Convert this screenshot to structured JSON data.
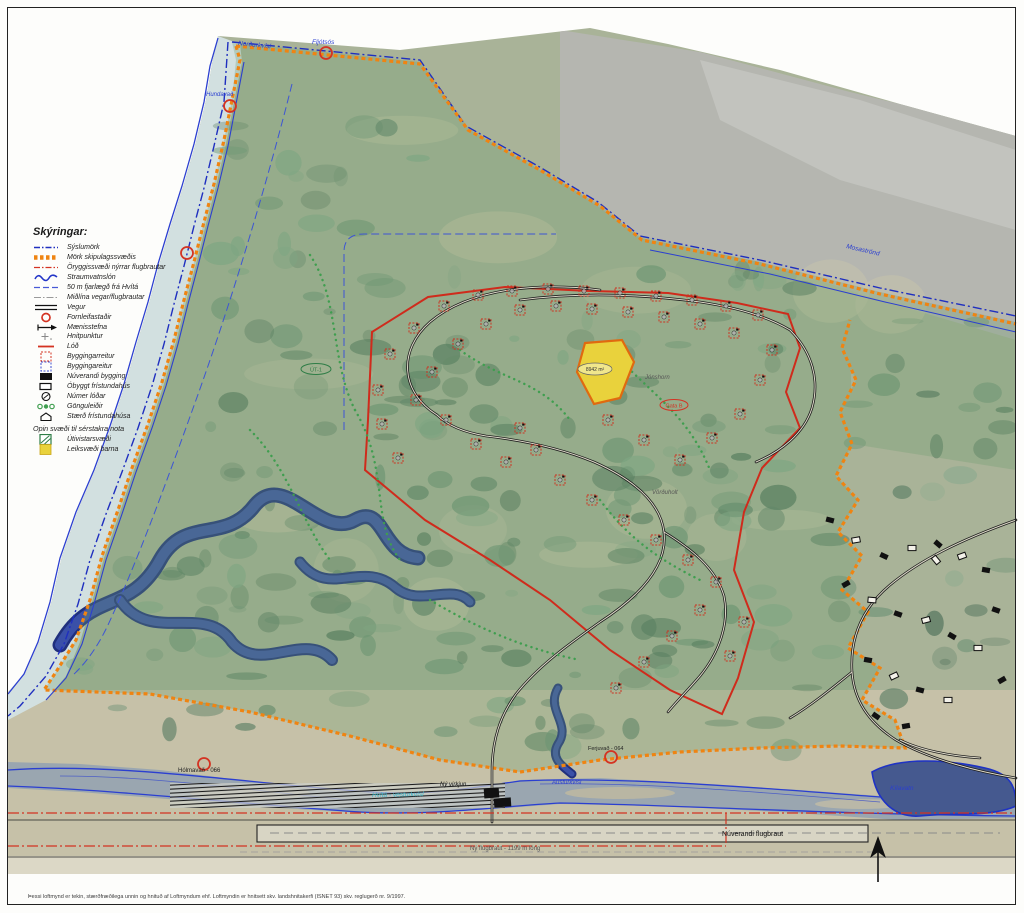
{
  "legend": {
    "title": "Skýringar:",
    "items": [
      {
        "label": "Sýslumörk"
      },
      {
        "label": "Mörk skipulagssvæðis"
      },
      {
        "label": "Öryggissvæði nýrrar flugbrautar"
      },
      {
        "label": "Straumvatnslón"
      },
      {
        "label": "50 m fjarlægð frá Hvítá"
      },
      {
        "label": "Miðlína vegar/flugbrautar"
      },
      {
        "label": "Vegur"
      },
      {
        "label": "Fornleifastaðir"
      },
      {
        "label": "Mænisstefna"
      },
      {
        "label": "Hnitpunktur"
      },
      {
        "label": "Lóð"
      },
      {
        "label": "Byggingarreitur"
      },
      {
        "label": "Byggingareitur"
      },
      {
        "label": "Núverandi bygging"
      },
      {
        "label": "Óbyggt frístundahús"
      },
      {
        "label": "Númer lóðar"
      },
      {
        "label": "Gönguleiðir"
      },
      {
        "label": "Stærð frístundahúsa"
      }
    ],
    "subheader": "Opin svæði til sérstakra nota",
    "open_items": [
      {
        "label": "Útivistarsvæði"
      },
      {
        "label": "Leiksvæði barna"
      }
    ]
  },
  "map_labels": {
    "river_top_left": "Norðurkvísl",
    "river_top_mid": "Fljótsós",
    "river_left": "Hundavað",
    "county_line_ne": "Mosaströnd",
    "open_area_tag": "ÚT-1",
    "playground_size": "8942 m²",
    "place_east": "Jónshorn",
    "road_tag": "Gata B",
    "place_south": "Vörðuholt",
    "heritage_sw": "Hólmavað - 066",
    "heritage_s": "Ferjuvað - 064",
    "new_plant": "Ný virkjun",
    "river_main": "Hvítá - vesturkvísl",
    "river_branch": "Austurkvísl",
    "lake_se": "Kílavatn",
    "runway_existing": "Núverandi flugbraut",
    "runway_new": "Ný flugbraut - 1199 m löng"
  },
  "footer": {
    "fine_print": "Þessi loftmynd er tekin, stærðfræðilega unnin og hnituð af Loftmyndum ehf.  Loftmyndin er hnitsett skv. landshnitakerfi (ISNET 93) skv. reglugerð nr. 9/1997."
  },
  "colors": {
    "county_line": "#1f2fbf",
    "plan_boundary": "#ef8412",
    "safety_line": "#d43322",
    "water": "#2436c8",
    "hatch_green": "#2e7d46",
    "playground_yellow": "#e9d23c",
    "lot_red": "#cc3322"
  }
}
